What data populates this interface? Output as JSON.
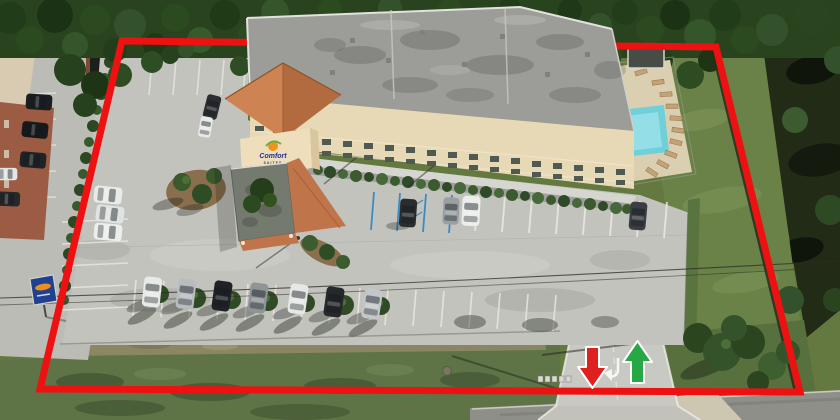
{
  "scene": {
    "kind": "aerial-drone-photo",
    "subject": "Hotel property aerial view with red parcel boundary overlay and entrance arrows"
  },
  "branding": {
    "logo_text": "Comfort",
    "logo_subtext": "SUITES"
  },
  "annotations": {
    "boundary_color": "#ee1111",
    "exit_arrow": {
      "direction": "down",
      "color": "#e02020"
    },
    "entry_arrow": {
      "direction": "up",
      "color": "#27a844"
    }
  },
  "colors": {
    "pool_water": "#6fd0da",
    "tower_roof": "#cd8452",
    "building_wall": "#e8d9b6",
    "building_roof": "#9c9c98"
  }
}
